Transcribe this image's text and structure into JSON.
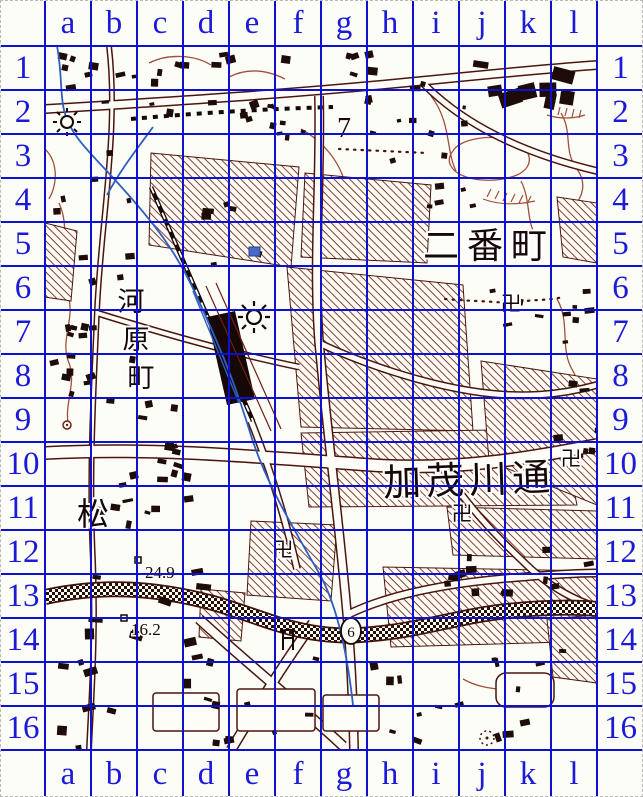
{
  "page": {
    "description": "Scanned Japanese city map with blue coordinate grid overlay"
  },
  "grid": {
    "columns": [
      "a",
      "b",
      "c",
      "d",
      "e",
      "f",
      "g",
      "h",
      "i",
      "j",
      "k",
      "l"
    ],
    "rows": [
      "1",
      "2",
      "3",
      "4",
      "5",
      "6",
      "7",
      "8",
      "9",
      "10",
      "11",
      "12",
      "13",
      "14",
      "15",
      "16"
    ],
    "line_color": "#1010cf",
    "label_color": "#1a1ad8"
  },
  "map": {
    "place_labels": [
      {
        "text": "二番町",
        "orientation": "horizontal"
      },
      {
        "text": "加茂川通",
        "orientation": "horizontal"
      },
      {
        "text": "河原町",
        "orientation": "vertical"
      },
      {
        "text": "松",
        "orientation": "horizontal"
      }
    ],
    "spot_values": [
      {
        "text": "24.9",
        "kind": "spot-elevation"
      },
      {
        "text": "16.2",
        "kind": "spot-elevation"
      },
      {
        "text": "7",
        "kind": "map-numeral"
      },
      {
        "text": "6",
        "kind": "route-number-in-oval"
      }
    ],
    "symbols": {
      "temple_glyph": "卍",
      "temple_count": 4,
      "icons": [
        "factory-gear-icon",
        "torii-icon",
        "route-oval-icon",
        "benchmark-square-icon",
        "well-icon",
        "shrine-dotted-icon"
      ]
    },
    "colors": {
      "linework": "#3f120a",
      "hatch": "#6b2014",
      "water": "#2e5ec4",
      "background": "#fdfdf8",
      "grid_blue": "#1010cf"
    }
  }
}
